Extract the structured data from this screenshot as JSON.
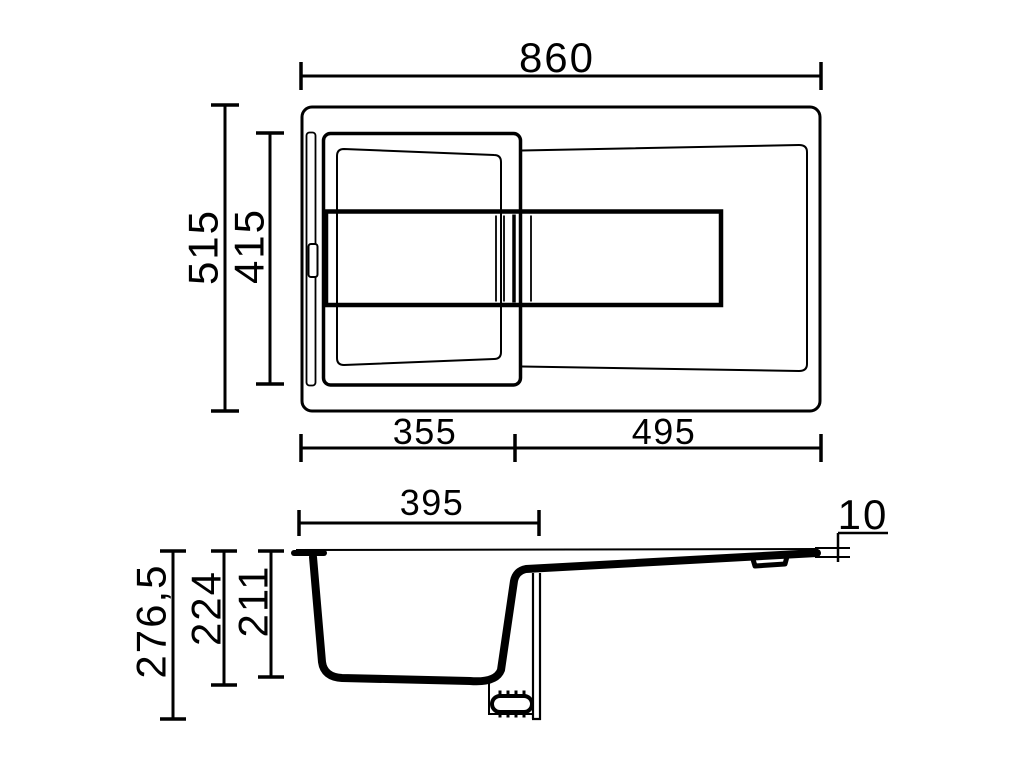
{
  "canvas": {
    "background": "#ffffff",
    "line_color": "#000000"
  },
  "top_view": {
    "dims": {
      "overall_width": "860",
      "overall_depth": "515",
      "inner_depth": "415",
      "bowl_width": "355",
      "drainer_width": "495"
    }
  },
  "section_view": {
    "dims": {
      "bowl_top_width": "395",
      "overall_height": "276,5",
      "bowl_depth_outer": "224",
      "bowl_depth_inner": "211",
      "edge_height": "10"
    }
  }
}
